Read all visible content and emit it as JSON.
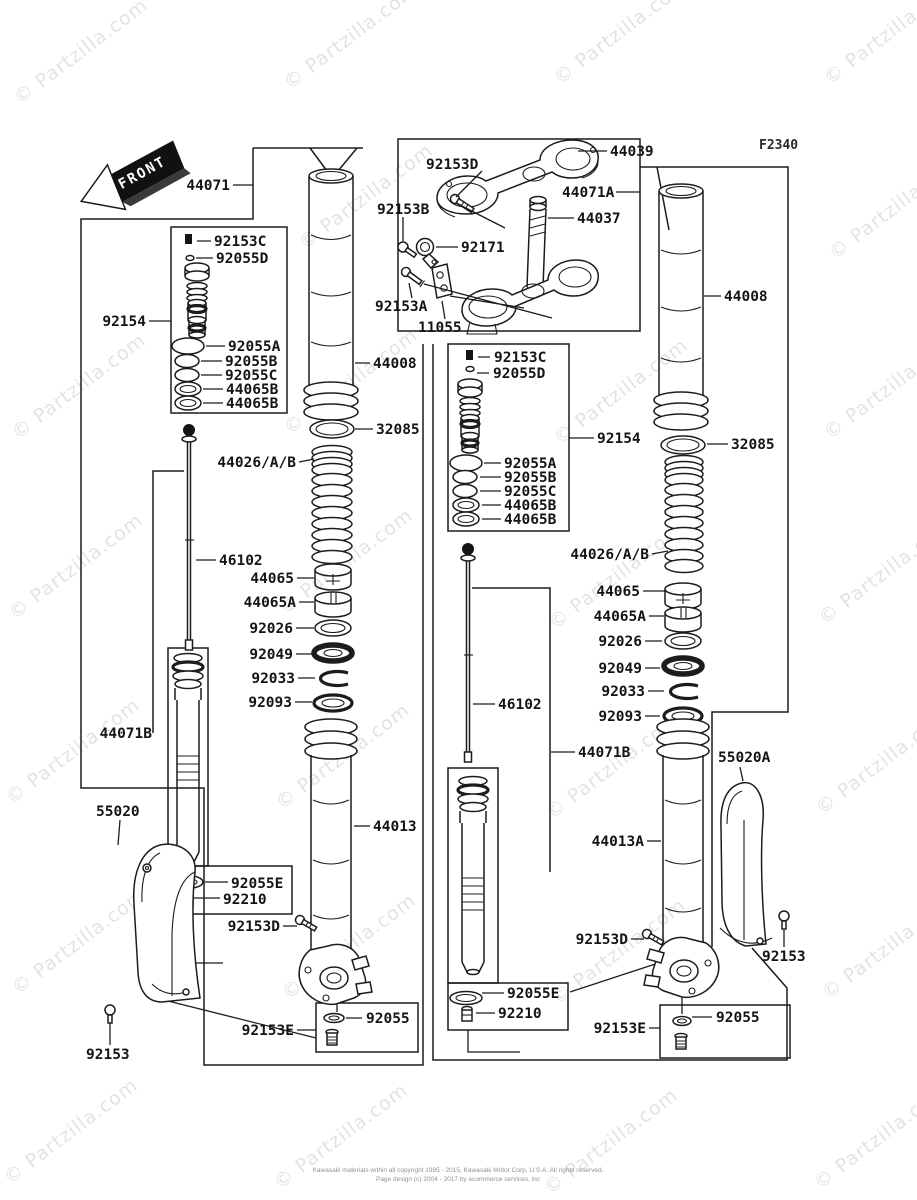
{
  "page": {
    "figure_code": "F2340",
    "watermark_text": "© Partzilla.com",
    "footer_line1": "Kawasaki materials within all copyright 1995 - 2015, Kawasaki Motor Corp, U.S.A. All rights reserved.",
    "footer_line2": "Page design (c) 2004 - 2017 by ecommerce services, inc"
  },
  "front_arrow": {
    "label": "FRONT"
  },
  "labels": [
    {
      "id": "44071",
      "text": "44071"
    },
    {
      "id": "92153c-left",
      "text": "92153C"
    },
    {
      "id": "92055d-left",
      "text": "92055D"
    },
    {
      "id": "92154-left",
      "text": "92154"
    },
    {
      "id": "92055a-left",
      "text": "92055A"
    },
    {
      "id": "92055b-left",
      "text": "92055B"
    },
    {
      "id": "92055c-left",
      "text": "92055C"
    },
    {
      "id": "44065b-left-1",
      "text": "44065B"
    },
    {
      "id": "44065b-left-2",
      "text": "44065B"
    },
    {
      "id": "44008-left",
      "text": "44008"
    },
    {
      "id": "32085-left",
      "text": "32085"
    },
    {
      "id": "44026ab-left",
      "text": "44026/A/B"
    },
    {
      "id": "46102-left",
      "text": "46102"
    },
    {
      "id": "44065-left",
      "text": "44065"
    },
    {
      "id": "44065a-left",
      "text": "44065A"
    },
    {
      "id": "92026-left",
      "text": "92026"
    },
    {
      "id": "92049-left",
      "text": "92049"
    },
    {
      "id": "92033-left",
      "text": "92033"
    },
    {
      "id": "92093-left",
      "text": "92093"
    },
    {
      "id": "44071b-left",
      "text": "44071B"
    },
    {
      "id": "55020",
      "text": "55020"
    },
    {
      "id": "44013",
      "text": "44013"
    },
    {
      "id": "92055e-left",
      "text": "92055E"
    },
    {
      "id": "92210-left",
      "text": "92210"
    },
    {
      "id": "92153d-left-lower",
      "text": "92153D"
    },
    {
      "id": "92055-left-bottom",
      "text": "92055"
    },
    {
      "id": "92153e-left-bottom",
      "text": "92153E"
    },
    {
      "id": "92153-left",
      "text": "92153"
    },
    {
      "id": "92153d-top",
      "text": "92153D"
    },
    {
      "id": "44039",
      "text": "44039"
    },
    {
      "id": "44071a",
      "text": "44071A"
    },
    {
      "id": "92153b",
      "text": "92153B"
    },
    {
      "id": "44037",
      "text": "44037"
    },
    {
      "id": "92171",
      "text": "92171"
    },
    {
      "id": "92153a",
      "text": "92153A"
    },
    {
      "id": "11055",
      "text": "11055"
    },
    {
      "id": "92153c-mid",
      "text": "92153C"
    },
    {
      "id": "92055d-mid",
      "text": "92055D"
    },
    {
      "id": "92154-mid",
      "text": "92154"
    },
    {
      "id": "92055a-mid",
      "text": "92055A"
    },
    {
      "id": "92055b-mid",
      "text": "92055B"
    },
    {
      "id": "92055c-mid",
      "text": "92055C"
    },
    {
      "id": "44065b-mid-1",
      "text": "44065B"
    },
    {
      "id": "44065b-mid-2",
      "text": "44065B"
    },
    {
      "id": "44008-right",
      "text": "44008"
    },
    {
      "id": "32085-right",
      "text": "32085"
    },
    {
      "id": "44026ab-right",
      "text": "44026/A/B"
    },
    {
      "id": "44065-right",
      "text": "44065"
    },
    {
      "id": "44065a-right",
      "text": "44065A"
    },
    {
      "id": "92026-right",
      "text": "92026"
    },
    {
      "id": "92049-right",
      "text": "92049"
    },
    {
      "id": "92033-right",
      "text": "92033"
    },
    {
      "id": "92093-right",
      "text": "92093"
    },
    {
      "id": "46102-right",
      "text": "46102"
    },
    {
      "id": "44071b-right",
      "text": "44071B"
    },
    {
      "id": "44013a",
      "text": "44013A"
    },
    {
      "id": "55020a",
      "text": "55020A"
    },
    {
      "id": "92153d-right-lower",
      "text": "92153D"
    },
    {
      "id": "92153-right",
      "text": "92153"
    },
    {
      "id": "92055e-right",
      "text": "92055E"
    },
    {
      "id": "92210-right",
      "text": "92210"
    },
    {
      "id": "92055-right-bottom",
      "text": "92055"
    },
    {
      "id": "92153e-right-bottom",
      "text": "92153E"
    }
  ]
}
